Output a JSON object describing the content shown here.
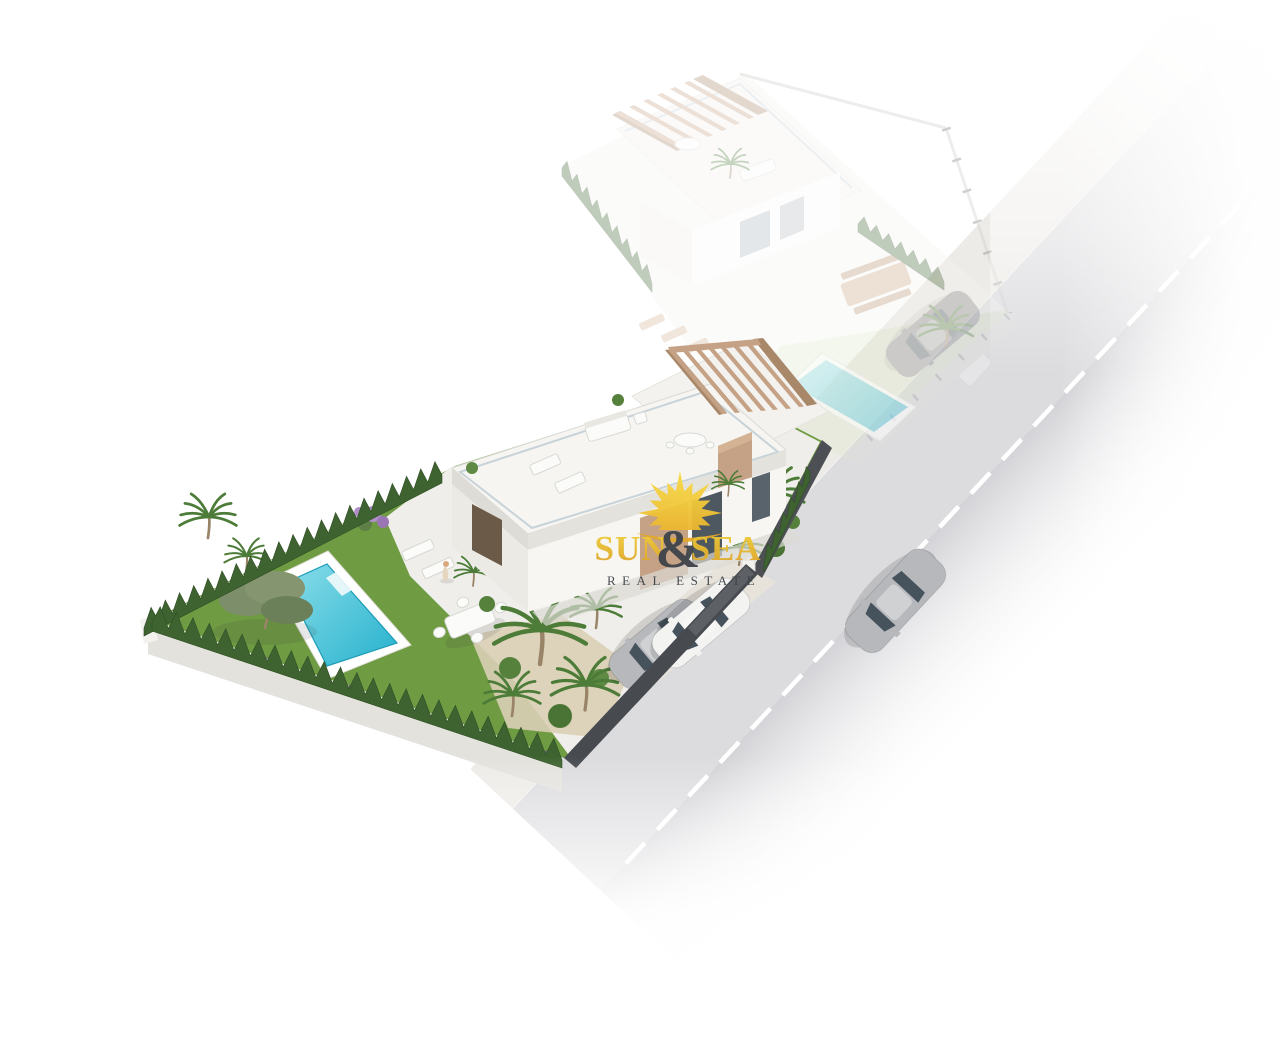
{
  "image": {
    "kind": "3d-aerial-architectural-render",
    "description": "Aerial 3D render of a modern white villa plot with private pool, lawn and palm garden beside a road; the neighbouring villa behind is shown faded; a Sun & Sea Real Estate watermark sits in the centre."
  },
  "watermark": {
    "brand_left": "SUN",
    "brand_amp": "&",
    "brand_right": "SEA",
    "tagline": "REAL ESTATE"
  },
  "colors": {
    "brand_yellow": "#EFC832",
    "sun_yellow": "#F9DF4A",
    "sun_gold": "#E2A82B",
    "brand_dark": "#3E4349",
    "lawn": "#6F9B43",
    "hedge": "#3E6330",
    "palm": "#4C7C38",
    "pool_water": "#2CB4CF",
    "pool_water_light": "#7FD9E6",
    "wall_light": "#F3F2EF",
    "wall_shade": "#E4E2DD",
    "pergola_wood": "#C5A285",
    "pergola_wood_dark": "#A9886A",
    "fence_dark": "#474B50",
    "road": "#DCDCDF",
    "road_far": "#D3D3D7",
    "sidewalk": "#EDEBE7",
    "car_silver": "#B6B8BC",
    "car_white": "#F3F3F2",
    "car_dark_faded": "#85878B",
    "sand": "#D9CFB5",
    "olive_foliage": "#85956F",
    "flower_purple": "#B18FC9",
    "skin": "#D9A87E",
    "faded_opacity": "0.32"
  },
  "scene": {
    "elements": {
      "main_villa": "modern white villa with roof terrace",
      "roof_pergola": "wooden pergola on roof terrace",
      "rooftop_dining_set": "round table with chairs under pergola",
      "rooftop_loungers": "two sun loungers on roof terrace",
      "private_pool": "turquoise pool with white deck",
      "garden_lawn": "green lawn",
      "olive_tree": "olive tree on lawn",
      "palm_trees": "palm trees",
      "cypress_hedge": "cypress hedge along boundary walls",
      "flowering_bush": "purple flowering bush",
      "garden_dining_table": "white garden table with chairs",
      "garden_loungers": "two sun loungers by the house",
      "person": "person standing on the terrace",
      "driveway": "driveway with two parked cars",
      "parked_cars": "silver and white parked cars",
      "driveway_fence": "dark grey street fence and gate",
      "street": "asphalt road with dashed centre line",
      "sidewalk": "light sidewalk strip",
      "street_car": "silver car driving on the road",
      "neighbor_villa": "faded neighbouring villa with pergola",
      "neighbor_pool": "faded neighbouring pool",
      "neighbor_car": "faded grey parked car",
      "watermark": "Sun & Sea Real Estate logo"
    }
  }
}
